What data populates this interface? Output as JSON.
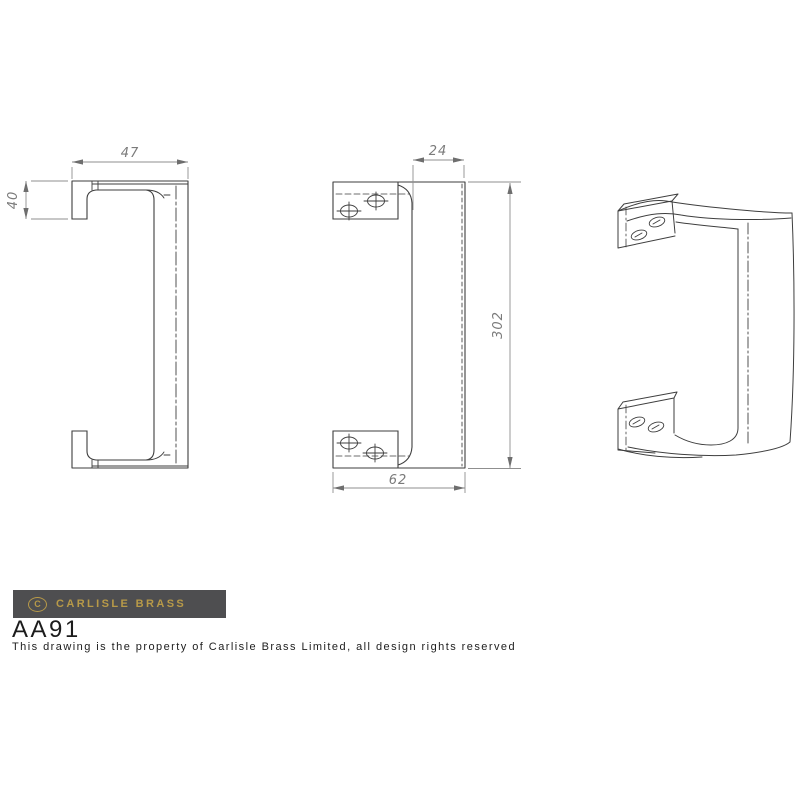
{
  "title": "Carlisle Brass AA91 pull handle technical drawing",
  "dimensions": {
    "top_width": "47",
    "foot_height": "40",
    "grip_depth": "24",
    "overall_height": "302",
    "base_width": "62"
  },
  "brand": {
    "mark": "C",
    "name": "CARLISLE BRASS"
  },
  "product": {
    "code": "AA91"
  },
  "footer": {
    "notice": "This drawing is the property of Carlisle Brass Limited, all design rights reserved"
  },
  "colors": {
    "outline": "#3e3e3e",
    "dimension": "#8f8f8f",
    "dim_text": "#7b7b7b",
    "logo_background": "#4e4e50",
    "logo_gold": "#b89a48",
    "text": "#1c1c1c",
    "page_background": "#ffffff"
  }
}
